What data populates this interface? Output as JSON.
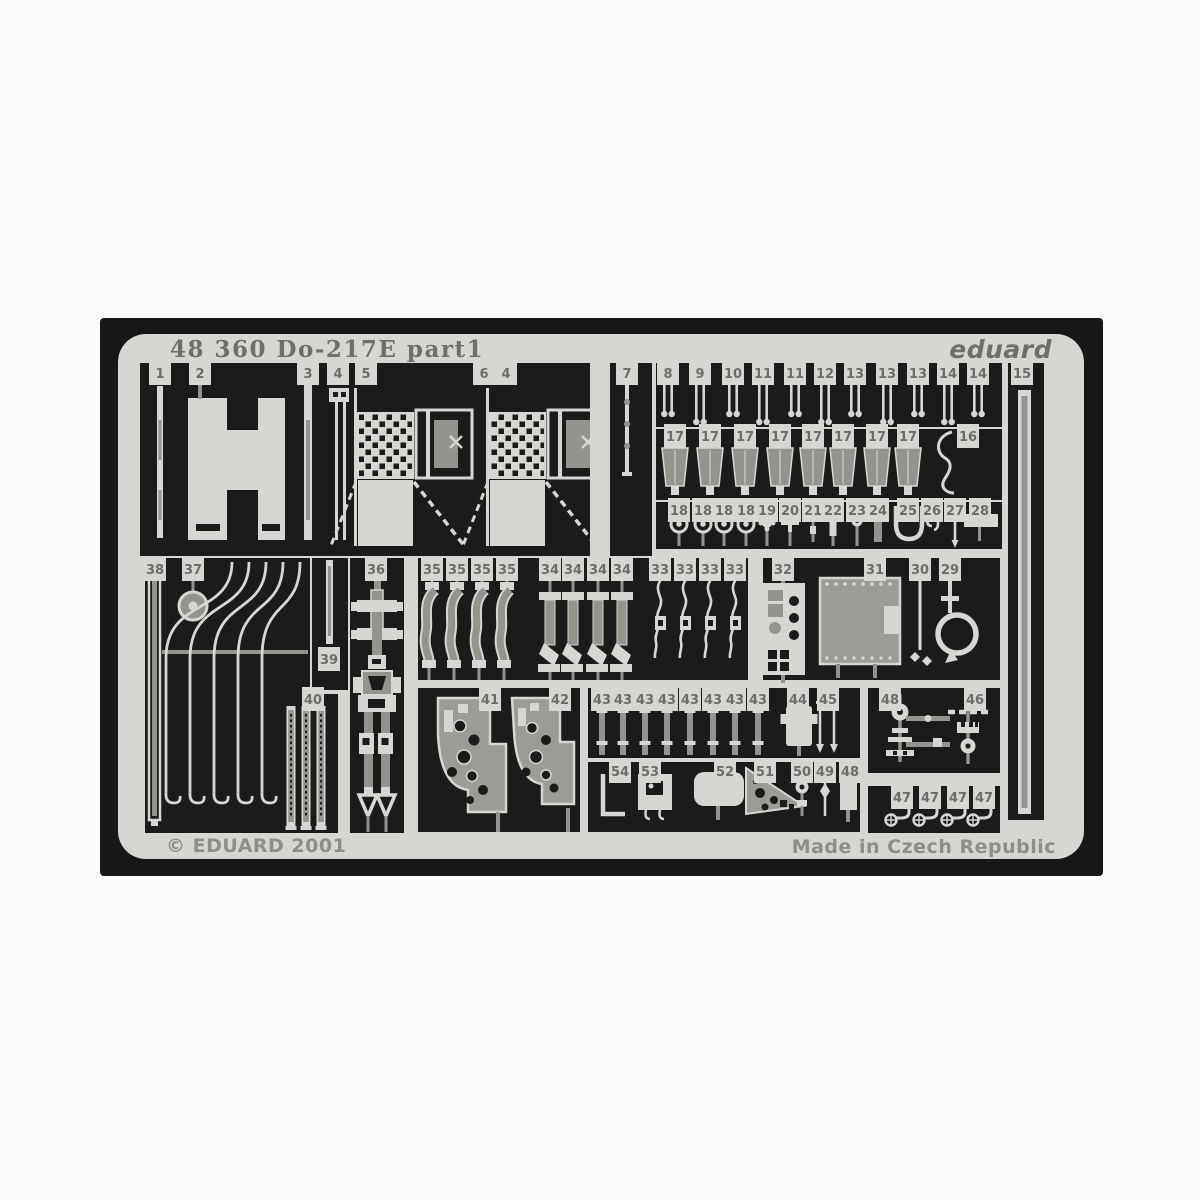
{
  "photo": {
    "title": "48 360 Do-217E  part1",
    "brand": "eduard",
    "copyright": "© EDUARD 2001",
    "made_in": "Made in Czech Republic",
    "colors": {
      "photo_background": "#171717",
      "metal_fret": "#d7d6d2",
      "half_etched_gray": "#94938d",
      "cutout_dark": "#1b1b1b",
      "etched_text": "#6e6e6a"
    }
  },
  "part_tabs": [
    {
      "label": "1",
      "x": 160,
      "y": 374
    },
    {
      "label": "2",
      "x": 200,
      "y": 374
    },
    {
      "label": "3",
      "x": 308,
      "y": 374
    },
    {
      "label": "4",
      "x": 338,
      "y": 374
    },
    {
      "label": "5",
      "x": 366,
      "y": 374
    },
    {
      "label": "6",
      "x": 484,
      "y": 374
    },
    {
      "label": "4",
      "x": 506,
      "y": 374
    },
    {
      "label": "7",
      "x": 627,
      "y": 374
    },
    {
      "label": "8",
      "x": 668,
      "y": 374
    },
    {
      "label": "9",
      "x": 700,
      "y": 374
    },
    {
      "label": "10",
      "x": 733,
      "y": 374
    },
    {
      "label": "11",
      "x": 763,
      "y": 374
    },
    {
      "label": "11",
      "x": 795,
      "y": 374
    },
    {
      "label": "12",
      "x": 825,
      "y": 374
    },
    {
      "label": "13",
      "x": 855,
      "y": 374
    },
    {
      "label": "13",
      "x": 887,
      "y": 374
    },
    {
      "label": "13",
      "x": 918,
      "y": 374
    },
    {
      "label": "14",
      "x": 948,
      "y": 374
    },
    {
      "label": "14",
      "x": 978,
      "y": 374
    },
    {
      "label": "15",
      "x": 1022,
      "y": 374
    },
    {
      "label": "17",
      "x": 675,
      "y": 437
    },
    {
      "label": "17",
      "x": 710,
      "y": 437
    },
    {
      "label": "17",
      "x": 745,
      "y": 437
    },
    {
      "label": "17",
      "x": 780,
      "y": 437
    },
    {
      "label": "17",
      "x": 813,
      "y": 437
    },
    {
      "label": "17",
      "x": 843,
      "y": 437
    },
    {
      "label": "17",
      "x": 877,
      "y": 437
    },
    {
      "label": "17",
      "x": 908,
      "y": 437
    },
    {
      "label": "16",
      "x": 968,
      "y": 437
    },
    {
      "label": "18",
      "x": 679,
      "y": 511
    },
    {
      "label": "18",
      "x": 703,
      "y": 511
    },
    {
      "label": "18",
      "x": 724,
      "y": 511
    },
    {
      "label": "18",
      "x": 746,
      "y": 511
    },
    {
      "label": "19",
      "x": 767,
      "y": 511
    },
    {
      "label": "20",
      "x": 790,
      "y": 511
    },
    {
      "label": "21",
      "x": 813,
      "y": 511
    },
    {
      "label": "22",
      "x": 833,
      "y": 511
    },
    {
      "label": "23",
      "x": 857,
      "y": 511
    },
    {
      "label": "24",
      "x": 878,
      "y": 511
    },
    {
      "label": "25",
      "x": 908,
      "y": 511
    },
    {
      "label": "26",
      "x": 932,
      "y": 511
    },
    {
      "label": "27",
      "x": 955,
      "y": 511
    },
    {
      "label": "28",
      "x": 980,
      "y": 511
    },
    {
      "label": "38",
      "x": 155,
      "y": 570
    },
    {
      "label": "37",
      "x": 193,
      "y": 570
    },
    {
      "label": "36",
      "x": 376,
      "y": 570
    },
    {
      "label": "35",
      "x": 432,
      "y": 570
    },
    {
      "label": "35",
      "x": 457,
      "y": 570
    },
    {
      "label": "35",
      "x": 482,
      "y": 570
    },
    {
      "label": "35",
      "x": 507,
      "y": 570
    },
    {
      "label": "34",
      "x": 550,
      "y": 570
    },
    {
      "label": "34",
      "x": 573,
      "y": 570
    },
    {
      "label": "34",
      "x": 598,
      "y": 570
    },
    {
      "label": "34",
      "x": 622,
      "y": 570
    },
    {
      "label": "33",
      "x": 660,
      "y": 570
    },
    {
      "label": "33",
      "x": 685,
      "y": 570
    },
    {
      "label": "33",
      "x": 710,
      "y": 570
    },
    {
      "label": "33",
      "x": 735,
      "y": 570
    },
    {
      "label": "32",
      "x": 783,
      "y": 570
    },
    {
      "label": "31",
      "x": 875,
      "y": 570
    },
    {
      "label": "30",
      "x": 920,
      "y": 570
    },
    {
      "label": "29",
      "x": 950,
      "y": 570
    },
    {
      "label": "39",
      "x": 329,
      "y": 660
    },
    {
      "label": "40",
      "x": 313,
      "y": 700
    },
    {
      "label": "41",
      "x": 490,
      "y": 700
    },
    {
      "label": "42",
      "x": 560,
      "y": 700
    },
    {
      "label": "43",
      "x": 602,
      "y": 700
    },
    {
      "label": "43",
      "x": 623,
      "y": 700
    },
    {
      "label": "43",
      "x": 645,
      "y": 700
    },
    {
      "label": "43",
      "x": 667,
      "y": 700
    },
    {
      "label": "43",
      "x": 690,
      "y": 700
    },
    {
      "label": "43",
      "x": 713,
      "y": 700
    },
    {
      "label": "43",
      "x": 735,
      "y": 700
    },
    {
      "label": "43",
      "x": 758,
      "y": 700
    },
    {
      "label": "44",
      "x": 798,
      "y": 700
    },
    {
      "label": "45",
      "x": 828,
      "y": 700
    },
    {
      "label": "48",
      "x": 890,
      "y": 700
    },
    {
      "label": "46",
      "x": 975,
      "y": 700
    },
    {
      "label": "54",
      "x": 620,
      "y": 772
    },
    {
      "label": "53",
      "x": 650,
      "y": 772
    },
    {
      "label": "52",
      "x": 725,
      "y": 772
    },
    {
      "label": "51",
      "x": 765,
      "y": 772
    },
    {
      "label": "50",
      "x": 802,
      "y": 772
    },
    {
      "label": "49",
      "x": 825,
      "y": 772
    },
    {
      "label": "48",
      "x": 850,
      "y": 772
    },
    {
      "label": "47",
      "x": 902,
      "y": 798
    },
    {
      "label": "47",
      "x": 930,
      "y": 798
    },
    {
      "label": "47",
      "x": 958,
      "y": 798
    },
    {
      "label": "47",
      "x": 984,
      "y": 798
    }
  ]
}
